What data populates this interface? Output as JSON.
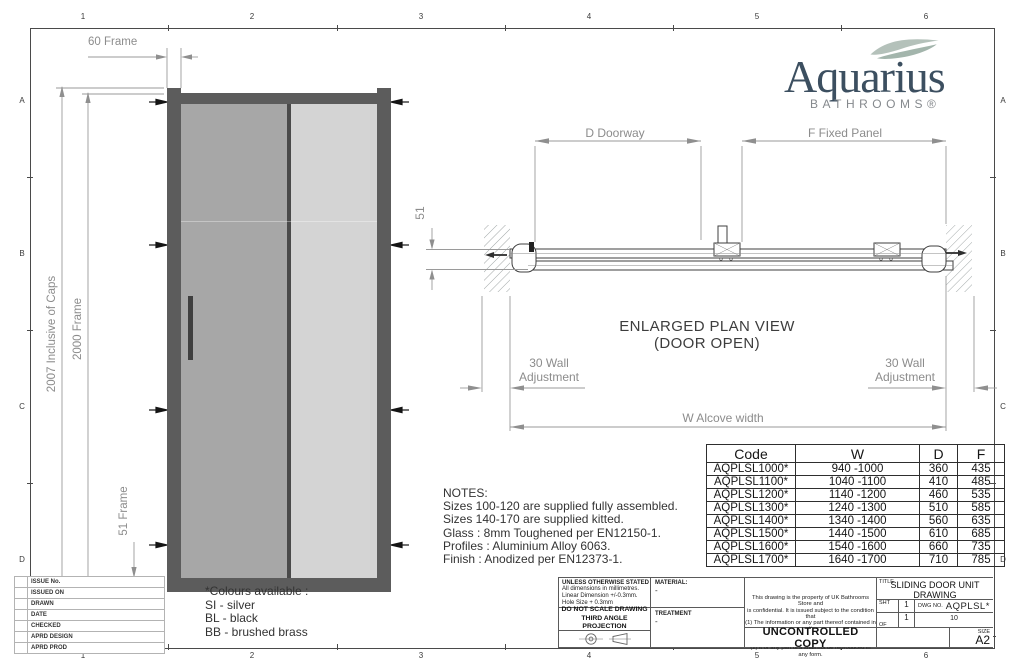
{
  "border": {
    "columns": [
      "1",
      "2",
      "3",
      "4",
      "5",
      "6"
    ],
    "rows": [
      "A",
      "B",
      "C",
      "D"
    ]
  },
  "logo": {
    "brand": "Aquarius",
    "subtitle": "BATHROOMS®",
    "brand_color": "#3c4f60",
    "swoosh_color": "#b4c1ba"
  },
  "elevation": {
    "frame_width_label": "60 Frame",
    "overall_height_label": "2007 Inclusive of Caps",
    "frame_height_label": "2000 Frame",
    "bottom_frame_label": "51 Frame"
  },
  "plan": {
    "title": "ENLARGED PLAN VIEW",
    "subtitle": "(DOOR OPEN)",
    "doorway_label": "D Doorway",
    "fixed_panel_label": "F Fixed Panel",
    "depth_label": "51",
    "wall_adjustment_line1": "30 Wall",
    "wall_adjustment_line2": "Adjustment",
    "alcove_label": "W Alcove width"
  },
  "notes": {
    "title": "NOTES:",
    "lines": [
      "Sizes 100-120 are supplied fully assembled.",
      "Sizes 140-170 are supplied kitted.",
      "Glass : 8mm Toughened per EN12150-1.",
      "Profiles : Aluminium Alloy 6063.",
      "Finish : Anodized per EN12373-1."
    ]
  },
  "colours": {
    "title": "*Colours available :",
    "options": [
      "SI - silver",
      "BL - black",
      "BB - brushed brass"
    ]
  },
  "size_table": {
    "headers": [
      "Code",
      "W",
      "D",
      "F"
    ],
    "rows": [
      [
        "AQPLSL1000*",
        "940 -1000",
        "360",
        "435"
      ],
      [
        "AQPLSL1100*",
        "1040 -1100",
        "410",
        "485"
      ],
      [
        "AQPLSL1200*",
        "1140 -1200",
        "460",
        "535"
      ],
      [
        "AQPLSL1300*",
        "1240 -1300",
        "510",
        "585"
      ],
      [
        "AQPLSL1400*",
        "1340 -1400",
        "560",
        "635"
      ],
      [
        "AQPLSL1500*",
        "1440 -1500",
        "610",
        "685"
      ],
      [
        "AQPLSL1600*",
        "1540 -1600",
        "660",
        "735"
      ],
      [
        "AQPLSL1700*",
        "1640 -1700",
        "710",
        "785"
      ]
    ]
  },
  "title_block": {
    "revision_rows": [
      "ISSUE No.",
      "ISSUED ON",
      "DRAWN",
      "DATE",
      "CHECKED",
      "APRD DESIGN",
      "APRD PROD"
    ],
    "tolerance_lines": [
      "UNLESS OTHERWISE STATED",
      "All dimensions in millimetres.",
      "Linear Dimension +/-0.3mm.",
      "Hole Size + 0.3mm"
    ],
    "material_label": "MATERIAL:",
    "material_value": "-",
    "scale_line1": "DO NOT SCALE DRAWING",
    "scale_line2": "THIRD ANGLE PROJECTION",
    "treatment_label": "TREATMENT",
    "treatment_value": "-",
    "legal_lines": [
      "This drawing is the property of UK Bathrooms Store and",
      "is confidential. It is issued subject to the condition that",
      "(1) The information or any part thereof contained in it",
      "shall not be disclosed in any form to a third party, and",
      "(2) it or any part of it shall not be reproduced in any form."
    ],
    "uncontrolled": "UNCONTROLLED COPY",
    "title_label": "TITLE",
    "drawing_title_line1": "SLIDING DOOR UNIT",
    "drawing_title_line2": "DRAWING",
    "sht_label": "SHT",
    "sht_value": "1",
    "of_label": "OF",
    "of_value": "1",
    "dwg_label": "DWG NO.",
    "dwg_value": "AQPLSL*",
    "dwg_sub": "10",
    "size_label": "SIZE",
    "size_value": "A2"
  }
}
